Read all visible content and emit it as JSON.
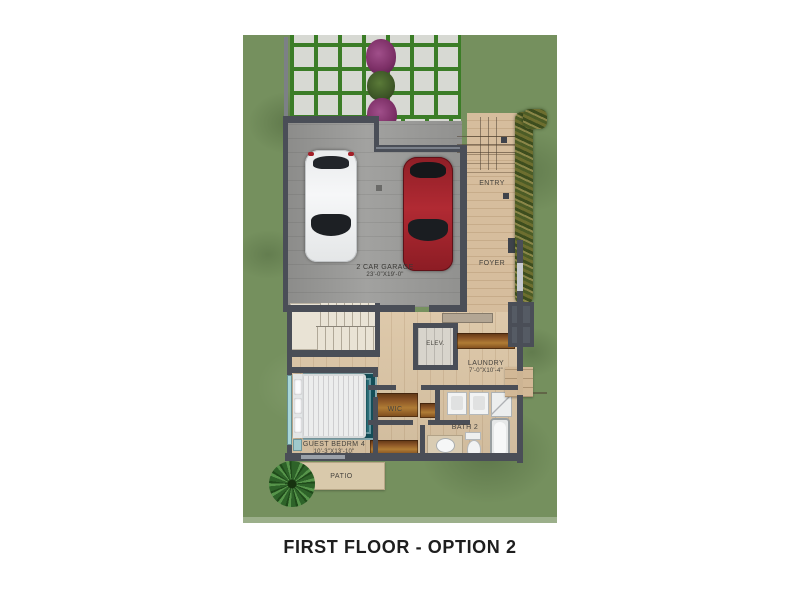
{
  "title": "FIRST FLOOR - OPTION 2",
  "rooms": {
    "garage": {
      "name": "2 CAR GARAGE",
      "dims": "23'-0\"X19'-0\""
    },
    "entry": {
      "name": "ENTRY"
    },
    "foyer": {
      "name": "FOYER"
    },
    "elevator": {
      "name": "ELEV."
    },
    "laundry": {
      "name": "LAUNDRY",
      "dims": "7'-0\"X10'-4\""
    },
    "wic": {
      "name": "WIC"
    },
    "bath2": {
      "name": "BATH 2"
    },
    "guest_bedroom": {
      "name": "GUEST BEDRM 4",
      "dims": "10'-3\"X13'-10\""
    },
    "patio": {
      "name": "PATIO"
    }
  },
  "colors": {
    "grass": "#75905e",
    "paver": "#d7d9d3",
    "paver_joint": "#3b7d27",
    "wall": "#4a4e57",
    "garage_floor": "#9c9c9a",
    "wood_floor": "#dcc6a6",
    "entry_floor": "#d6bd9d",
    "stair": "#e9e3d5",
    "rug": "#1e6570",
    "counter_brown": "#8a5426",
    "car_white": "#f2f3f4",
    "car_red": "#a8242e",
    "flower_purple": "#8a3b74",
    "patio": "#d9c9ab",
    "hedge": "#6f7030",
    "label_text": "#46433e",
    "title_text": "#1e1e1e"
  }
}
